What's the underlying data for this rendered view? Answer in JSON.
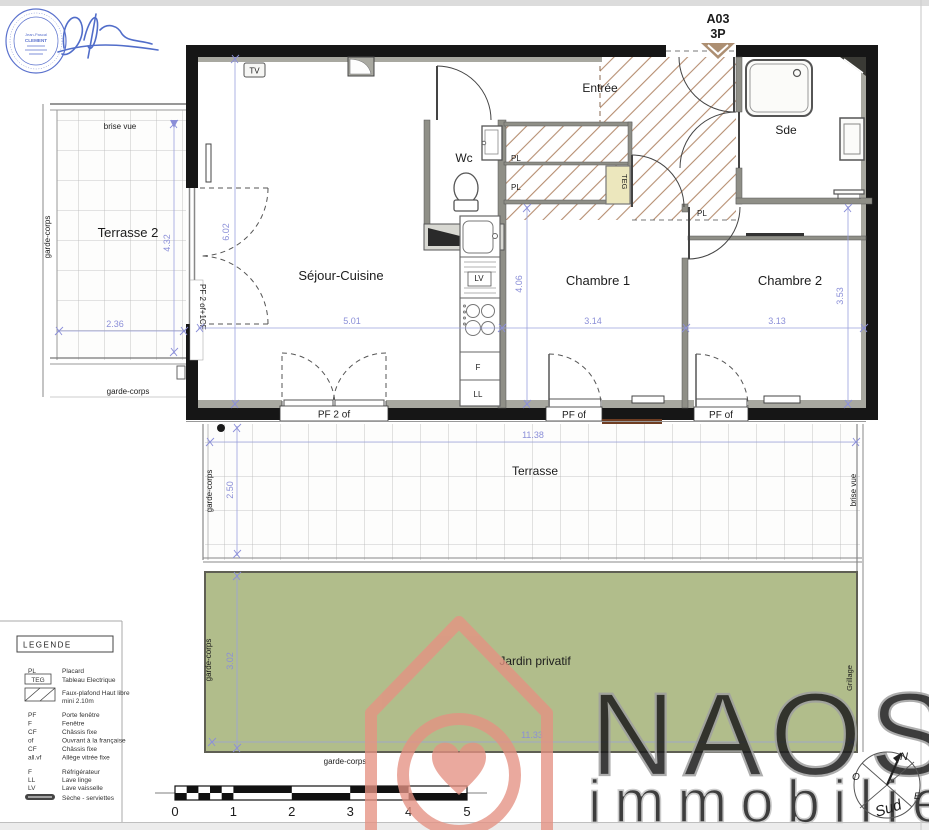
{
  "header": {
    "unit": "A03",
    "type": "3P"
  },
  "stamp": {
    "name_line1": "Jean-Pascal",
    "name_line2": "CLEMENT"
  },
  "rooms": {
    "entree": "Entrée",
    "sde": "Sde",
    "wc": "Wc",
    "sejour_cuisine": "Séjour-Cuisine",
    "chambre1": "Chambre 1",
    "chambre2": "Chambre 2",
    "terrasse2": "Terrasse 2",
    "terrasse": "Terrasse",
    "jardin": "Jardin privatif"
  },
  "fixtures": {
    "tv": "TV",
    "teg": "TEG",
    "lave_vaisselle": "LV",
    "refrigerateur": "F",
    "lave_linge": "LL",
    "placard": "PL"
  },
  "openings": {
    "left_window": "PF 2 of+1CF",
    "sejour_door": "PF 2 of",
    "chambre1_door": "PF of",
    "chambre2_door": "PF of"
  },
  "site": {
    "brise_vue": "brise vue",
    "garde_corps": "garde-corps",
    "grillage": "Grillage"
  },
  "dims": {
    "sejour_height": "6.02",
    "sejour_width": "5.01",
    "kitchen_height": "4.06",
    "chambre1_width": "3.14",
    "chambre2_width": "3.13",
    "chambre2_height": "3.53",
    "terrasse2_height": "4.32",
    "terrasse2_width": "2.36",
    "terrasse_width": "11.38",
    "terrasse_depth": "2.50",
    "jardin_width": "11.33",
    "jardin_depth": "3.02"
  },
  "legend": {
    "title": "LEGENDE",
    "items": [
      {
        "abbr": "PL",
        "label": "Placard"
      },
      {
        "abbr": "TEG",
        "label": "Tableau Electrique"
      },
      {
        "abbr": "",
        "label": "Faux-plafond Haut libre",
        "label2": "mini 2.10m"
      },
      {
        "abbr": "PF",
        "label": "Porte fenêtre"
      },
      {
        "abbr": "F",
        "label": "Fenêtre"
      },
      {
        "abbr": "CF",
        "label": "Châssis fixe"
      },
      {
        "abbr": "of",
        "label": "Ouvrant à la française"
      },
      {
        "abbr": "CF",
        "label": "Châssis fixe"
      },
      {
        "abbr": "all.vf",
        "label": "Allège vitrée fixe"
      },
      {
        "abbr": "F",
        "label": "Réfrigérateur"
      },
      {
        "abbr": "LL",
        "label": "Lave linge"
      },
      {
        "abbr": "LV",
        "label": "Lave vaisselle"
      },
      {
        "abbr": "",
        "label": "Sèche - serviettes"
      }
    ]
  },
  "scalebar": {
    "ticks": [
      "0",
      "1",
      "2",
      "3",
      "4",
      "5"
    ]
  },
  "branding": {
    "name": "NAOS",
    "tagline": "immobilier"
  },
  "compass": {
    "north": "N",
    "west": "O",
    "east": "E",
    "south": "Sud"
  },
  "colors": {
    "wall": "#161616",
    "hatch": "#b68e70",
    "jardin_green": "#b1bd8b",
    "dim_blue": "#8b8fd8",
    "teg_yellow": "#ece7bd",
    "watermark_salmon": "#e59283",
    "stamp_blue": "#4a63c8"
  }
}
